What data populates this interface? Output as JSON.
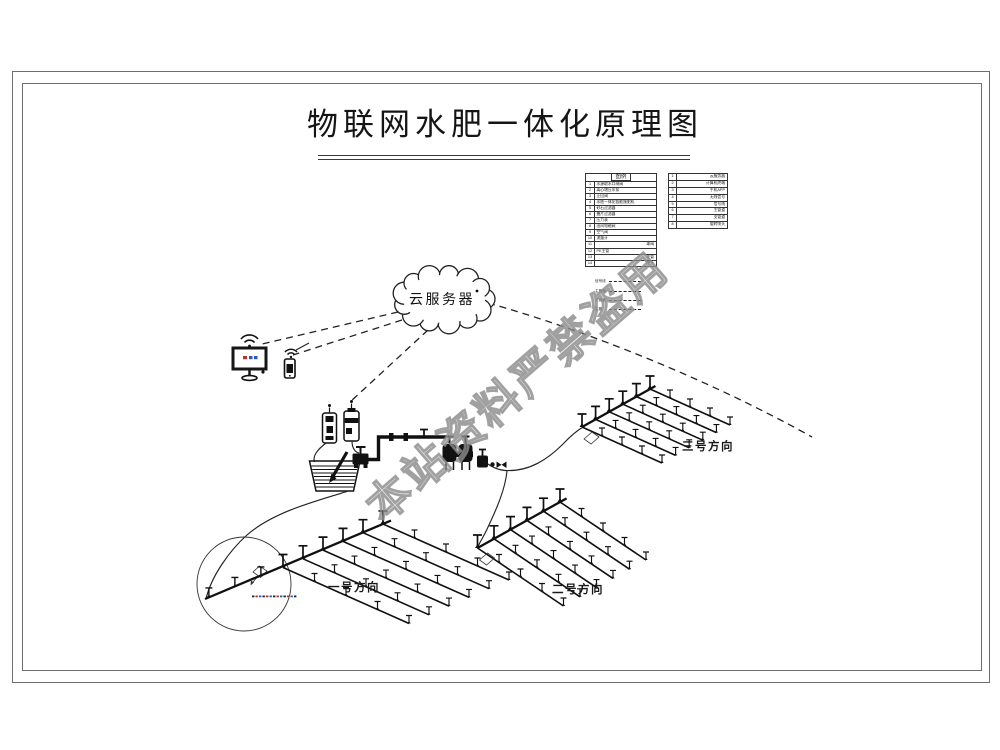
{
  "page": {
    "background": "#ffffff",
    "ink": "#1a1a1a",
    "watermark_color": "#909090",
    "accent_red": "#b3352b",
    "accent_blue": "#2d57c0"
  },
  "title": {
    "text": "物联网水肥一体化原理图"
  },
  "watermark": {
    "text": "本站资料严禁盗用"
  },
  "cloud": {
    "label": "云服务器"
  },
  "icons": {
    "wifi": "wifi-icon",
    "monitor": "monitor-icon",
    "phone": "phone-icon",
    "cloud": "cloud-shape"
  },
  "legend_main": {
    "title": "图例",
    "rows": [
      [
        "1",
        "水源取水口闸阀"
      ],
      [
        "2",
        "离心增压水泵"
      ],
      [
        "3",
        "止回阀"
      ],
      [
        "4",
        "水肥一体化智能施肥机"
      ],
      [
        "5",
        "砂石过滤器"
      ],
      [
        "6",
        "叠片过滤器"
      ],
      [
        "7",
        "压力表"
      ],
      [
        "8",
        "田间电磁阀"
      ],
      [
        "9",
        "空气阀"
      ],
      [
        "10",
        "流量计"
      ],
      [
        "11",
        "球阀"
      ],
      [
        "12",
        "PE主管"
      ],
      [
        "13",
        "支管"
      ],
      [
        "14",
        "喷头"
      ]
    ]
  },
  "legend_secondary": {
    "rows": [
      [
        "1",
        "云服务器"
      ],
      [
        "2",
        "计算机终端"
      ],
      [
        "3",
        "手机APP"
      ],
      [
        "4",
        "无线信号"
      ],
      [
        "5",
        "信号线"
      ],
      [
        "6",
        "主管道"
      ],
      [
        "7",
        "支管道"
      ],
      [
        "8",
        "旋转喷头"
      ]
    ]
  },
  "line_legend": {
    "rows": [
      "信号线",
      "主管道",
      "支管道",
      "毛管"
    ]
  },
  "fields": [
    {
      "label": "一号方向",
      "labelPos": [
        328,
        591
      ],
      "origin": [
        383,
        524
      ],
      "mainStep": [
        -20,
        8.7
      ],
      "nJ": 6,
      "tail": {
        "steps": 3,
        "step": [
          -26,
          10.5
        ]
      },
      "lat": [
        126,
        56
      ],
      "valveBox": false
    },
    {
      "label": "二号方向",
      "labelPos": [
        552,
        593
      ],
      "origin": [
        560,
        502
      ],
      "mainStep": [
        -16.5,
        9.2
      ],
      "nJ": 6,
      "tail": null,
      "lat": [
        86,
        58
      ],
      "valveBox": true
    },
    {
      "label": "三号方向",
      "labelPos": [
        682,
        450
      ],
      "origin": [
        650,
        389
      ],
      "mainStep": [
        -13.6,
        7.6
      ],
      "nJ": 6,
      "tail": null,
      "lat": [
        80,
        36
      ],
      "valveBox": true
    }
  ]
}
